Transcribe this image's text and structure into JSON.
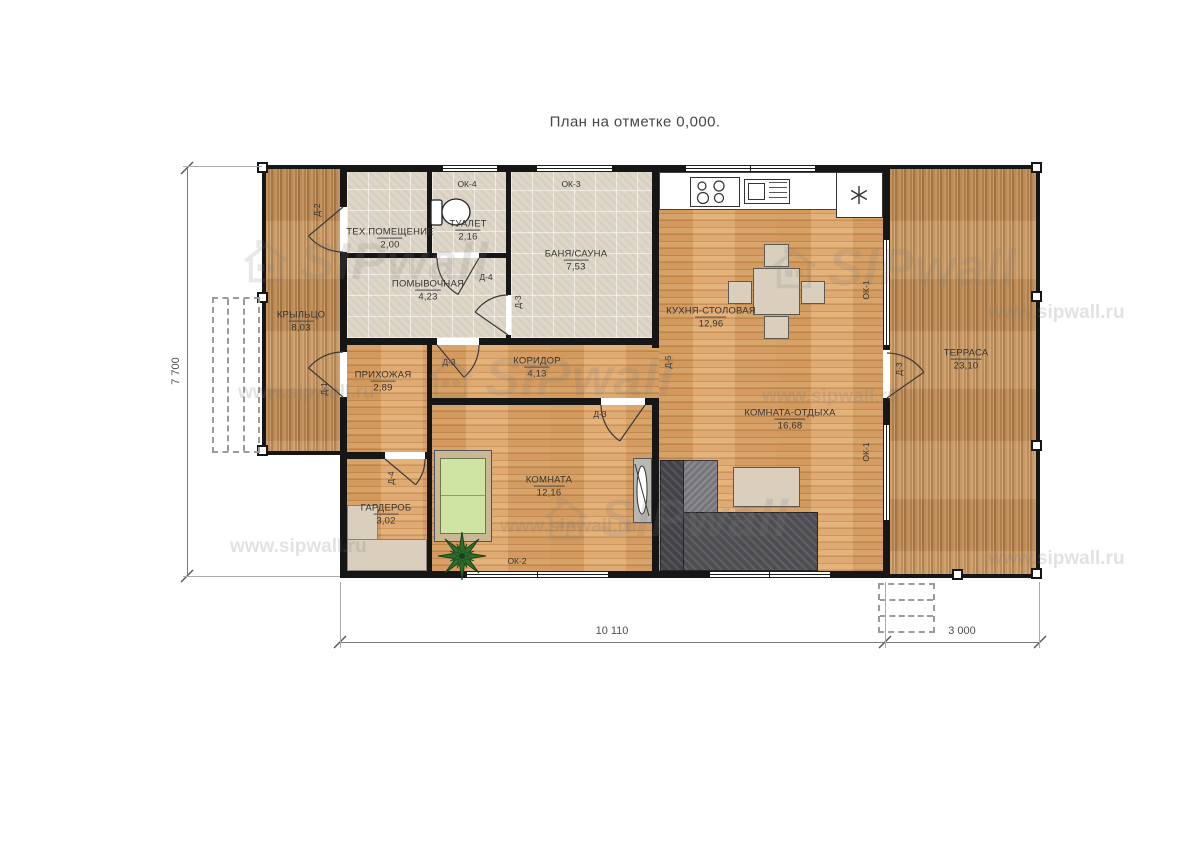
{
  "title": "План на отметке 0,000.",
  "watermark": {
    "brand": "SIPwall",
    "url": "www.sipwall.ru"
  },
  "rooms": {
    "porch": {
      "name": "КРЫЛЬЦО",
      "area": "8,03"
    },
    "tech": {
      "name": "ТЕХ.ПОМЕЩЕНИЕ",
      "area": "2,00"
    },
    "toilet": {
      "name": "ТУАЛЕТ",
      "area": "2,16"
    },
    "sauna": {
      "name": "БАНЯ/САУНА",
      "area": "7,53"
    },
    "washroom": {
      "name": "ПОМЫВОЧНАЯ",
      "area": "4,23"
    },
    "hall": {
      "name": "ПРИХОЖАЯ",
      "area": "2,89"
    },
    "corridor": {
      "name": "КОРИДОР",
      "area": "4,13"
    },
    "kitchen": {
      "name": "КУХНЯ-СТОЛОВАЯ",
      "area": "12,96"
    },
    "lounge": {
      "name": "КОМНАТА-ОТДЫХА",
      "area": "16,68"
    },
    "bedroom": {
      "name": "КОМНАТА",
      "area": "12,16"
    },
    "wardrobe": {
      "name": "ГАРДЕРОБ",
      "area": "3,02"
    },
    "terrace": {
      "name": "ТЕРРАСА",
      "area": "23,10"
    }
  },
  "openings": {
    "windows": {
      "kitchen": "ОК-1",
      "lounge": "ОК-1",
      "bedroom": "ОК-2",
      "sauna": "ОК-3",
      "toilet": "ОК-4"
    },
    "doors": {
      "porch_top": "Д-2",
      "porch_bottom": "Д-1",
      "toilet": "Д-4",
      "washroom_hall": "Д-3",
      "sauna": "Д-3",
      "bedroom": "Д-3",
      "wardrobe": "Д-4",
      "terrace": "Д-3",
      "kitchen_opening": "Д-5"
    }
  },
  "dims": {
    "height": "7 700",
    "width_main": "10 110",
    "width_terrace": "3 000"
  }
}
